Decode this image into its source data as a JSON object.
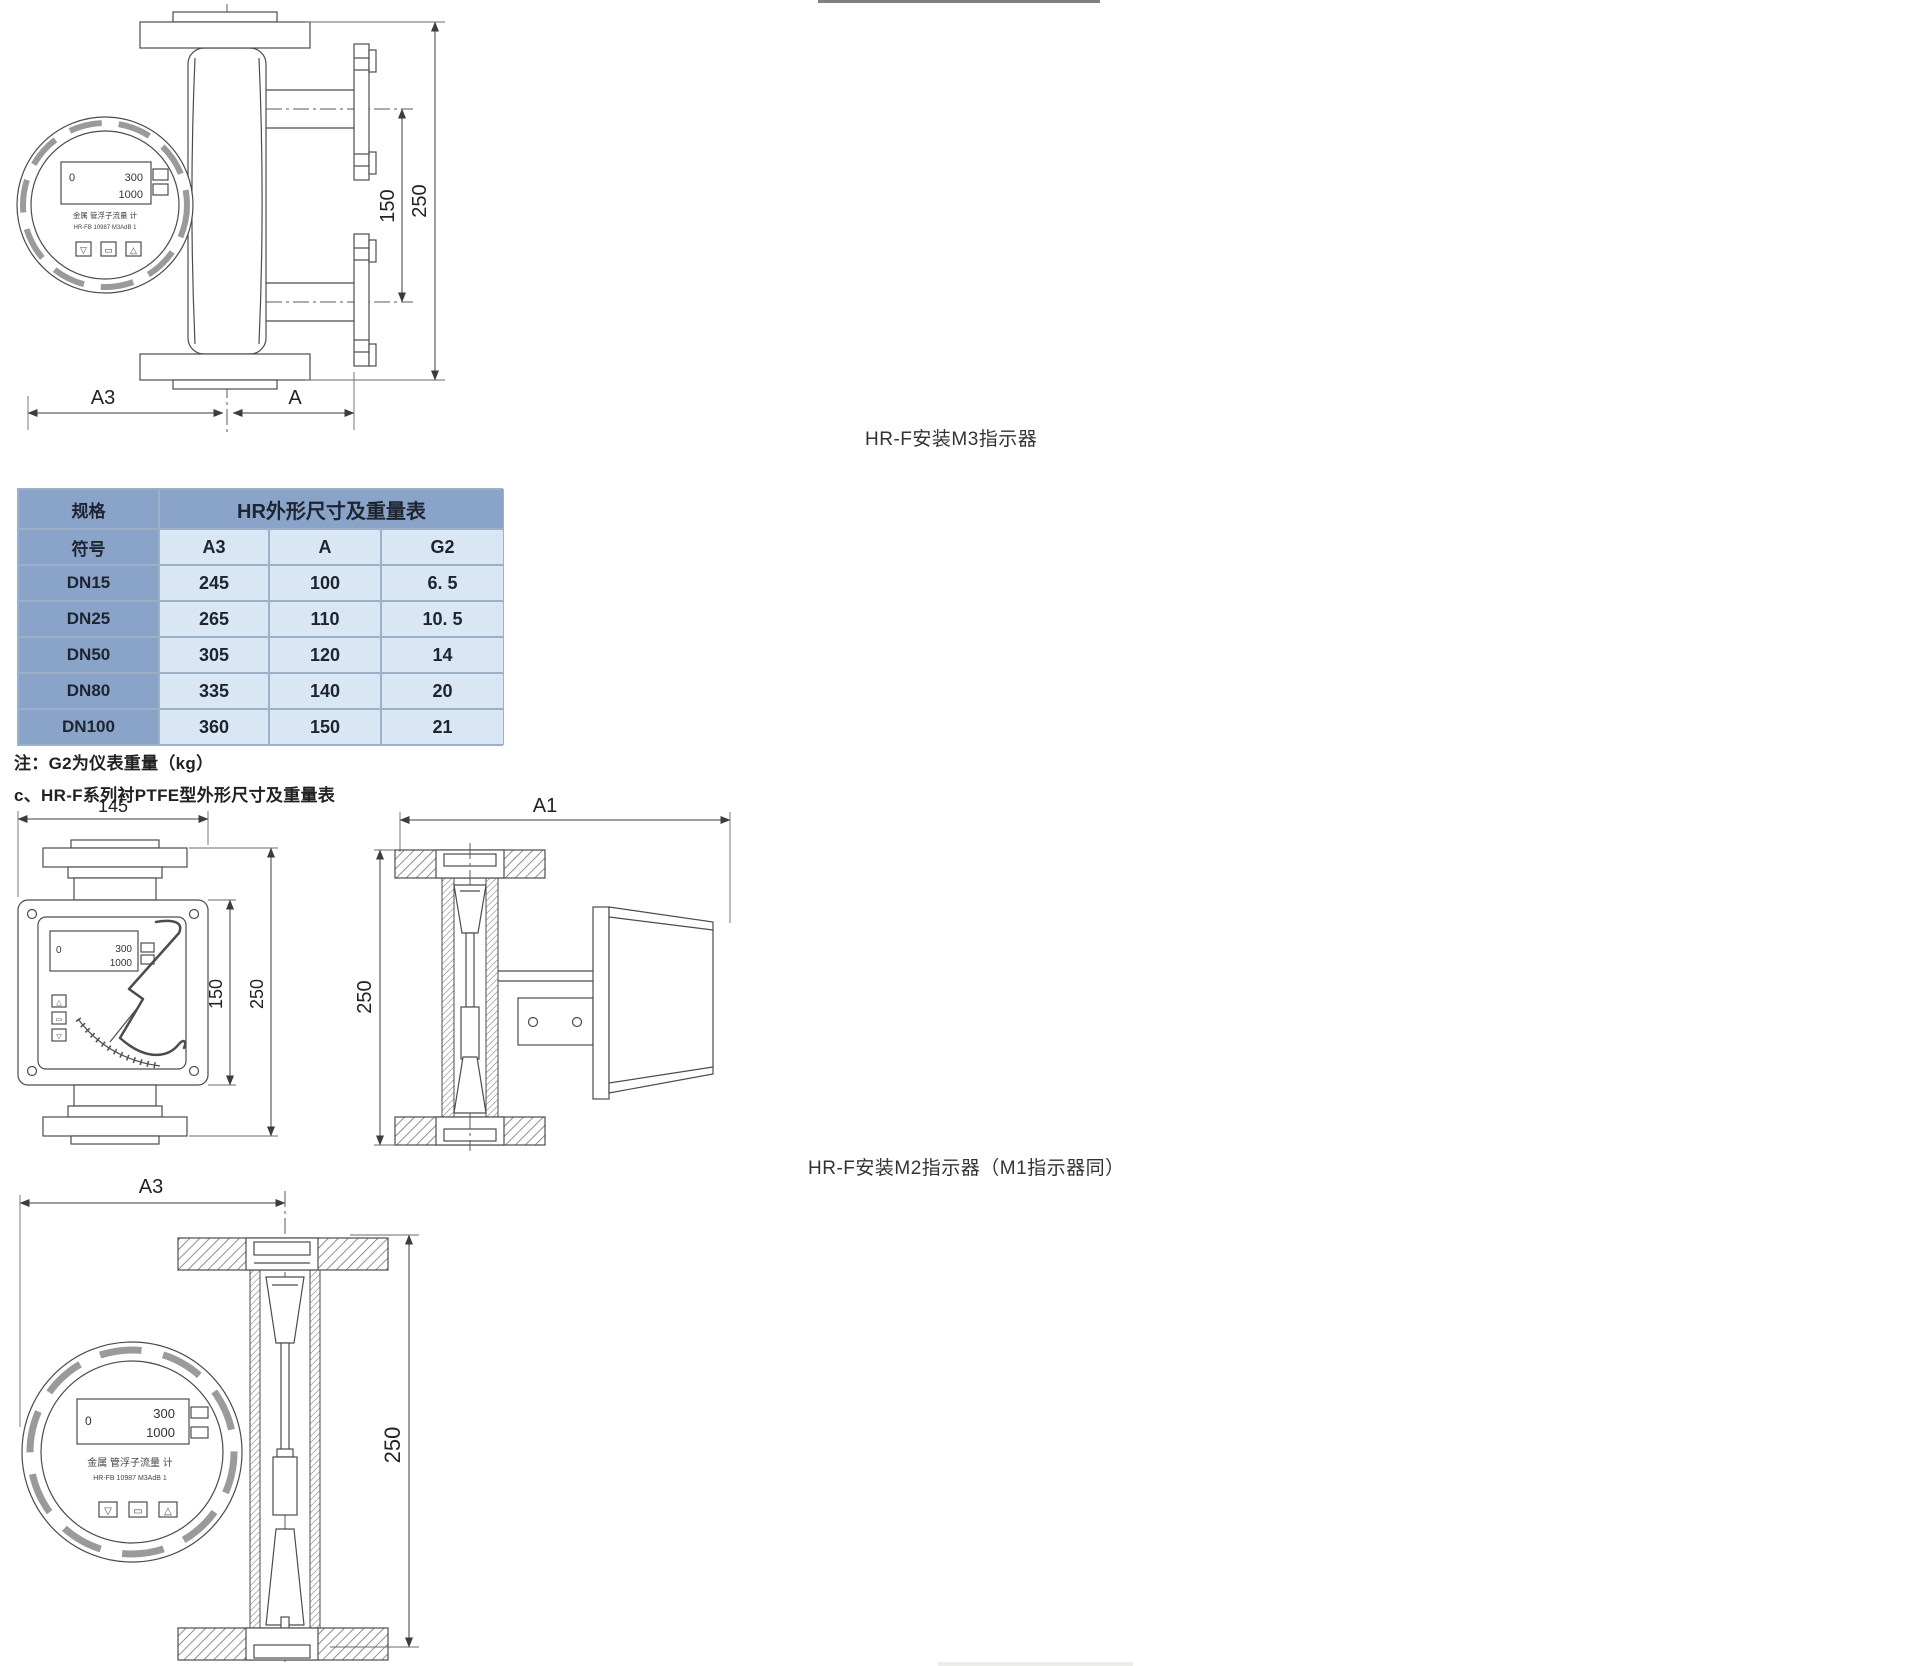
{
  "captions": {
    "m3_indicator": "HR-F安装M3指示器",
    "m2_indicator": "HR-F安装M2指示器（M1指示器同）"
  },
  "notes": {
    "g2_weight": "注：G2为仪表重量（kg）",
    "section_c": "c、HR-F系列衬PTFE型外形尺寸及重量表"
  },
  "table": {
    "corner_header": "规格",
    "title": "HR外形尺寸及重量表",
    "symbol_header": "符号",
    "columns": [
      "A3",
      "A",
      "G2"
    ],
    "rows": [
      {
        "spec": "DN15",
        "a3": "245",
        "a": "100",
        "g2": "6. 5"
      },
      {
        "spec": "DN25",
        "a3": "265",
        "a": "110",
        "g2": "10. 5"
      },
      {
        "spec": "DN50",
        "a3": "305",
        "a": "120",
        "g2": "14"
      },
      {
        "spec": "DN80",
        "a3": "335",
        "a": "140",
        "g2": "20"
      },
      {
        "spec": "DN100",
        "a3": "360",
        "a": "150",
        "g2": "21"
      }
    ],
    "colors": {
      "dark_bg": "#8aa3c8",
      "light_bg": "#d9e7f4",
      "border": "#9db0c8",
      "text": "#1e2430"
    }
  },
  "diagram_side_m3": {
    "dim_150": "150",
    "dim_250": "250",
    "dim_a3": "A3",
    "dim_a": "A",
    "lcd": {
      "left": "0",
      "row1": "300",
      "row2": "1000"
    },
    "face_line1": "金属 管浮子流量 计",
    "face_line2": "HR-FB 10987 M3AdB 1",
    "buttons": [
      "▽",
      "▭",
      "△"
    ]
  },
  "diagram_front_m2": {
    "dim_145": "145",
    "dim_150": "150",
    "dim_250": "250",
    "lcd": {
      "left": "0",
      "row1": "300",
      "row2": "1000"
    },
    "buttons": [
      "△",
      "▭",
      "▽"
    ]
  },
  "diagram_section_a1": {
    "dim_a1": "A1",
    "dim_250": "250"
  },
  "diagram_front_bottom": {
    "dim_a3": "A3",
    "dim_250": "250",
    "lcd": {
      "left": "0",
      "row1": "300",
      "row2": "1000"
    },
    "face_line1": "金属 管浮子流量 计",
    "face_line2": "HR-FB 10987 M3AdB 1",
    "buttons": [
      "▽",
      "▭",
      "△"
    ]
  }
}
